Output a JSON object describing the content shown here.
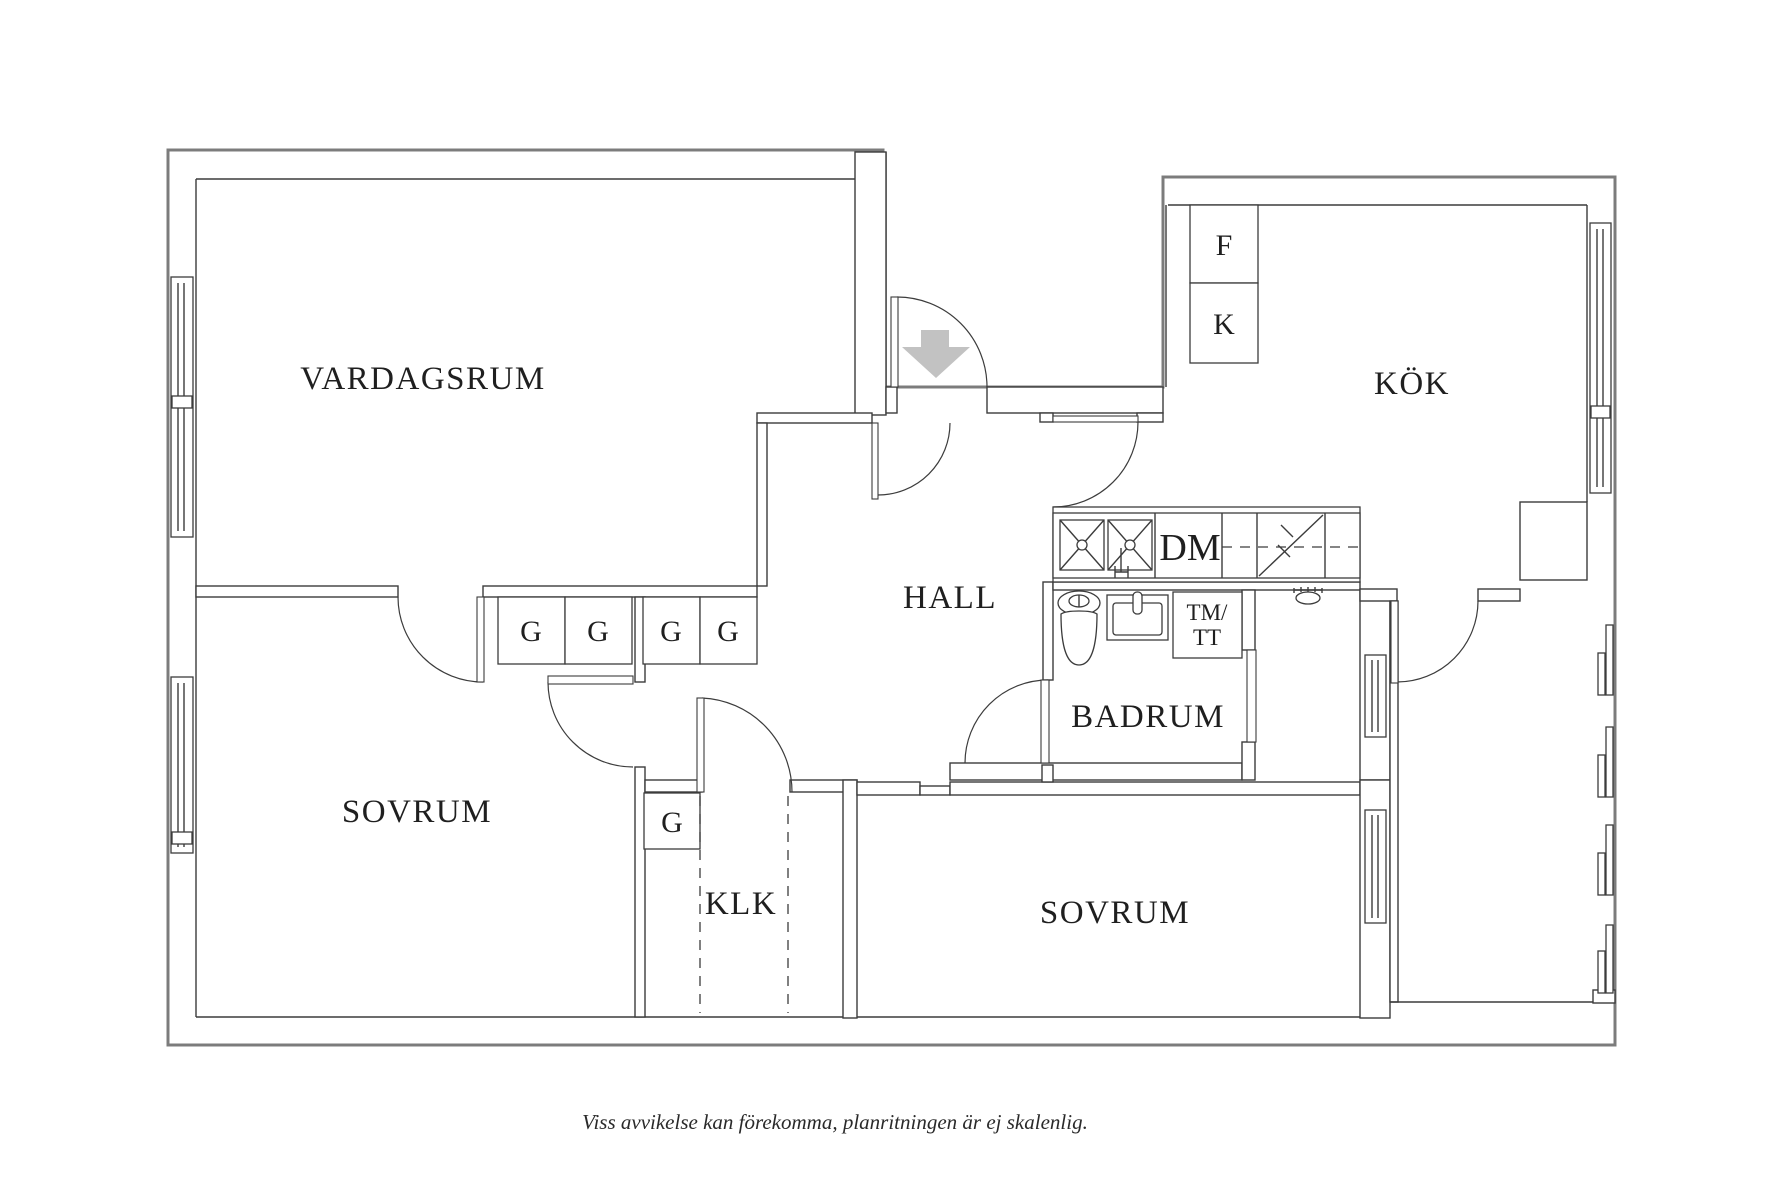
{
  "plan": {
    "type": "apartment-floor-plan",
    "caption": "Viss avvikelse kan förekomma, planritningen är ej skalenlig."
  },
  "rooms": {
    "living_room": "VARDAGSRUM",
    "kitchen": "KÖK",
    "hall": "HALL",
    "bathroom": "BADRUM",
    "bedroom_left": "SOVRUM",
    "bedroom_right": "SOVRUM",
    "closet": "KLK"
  },
  "labels": {
    "wardrobe": "G",
    "fridge": "F",
    "freezer": "K",
    "dishwasher": "DM",
    "washer_line1": "TM/",
    "washer_line2": "TT"
  },
  "colors": {
    "wall_line": "#3c3c3c",
    "outer_outline": "#7c7c7c",
    "entrance_arrow": "#c2c2c2",
    "label_text": "#1f1f1f",
    "background": "#ffffff"
  }
}
